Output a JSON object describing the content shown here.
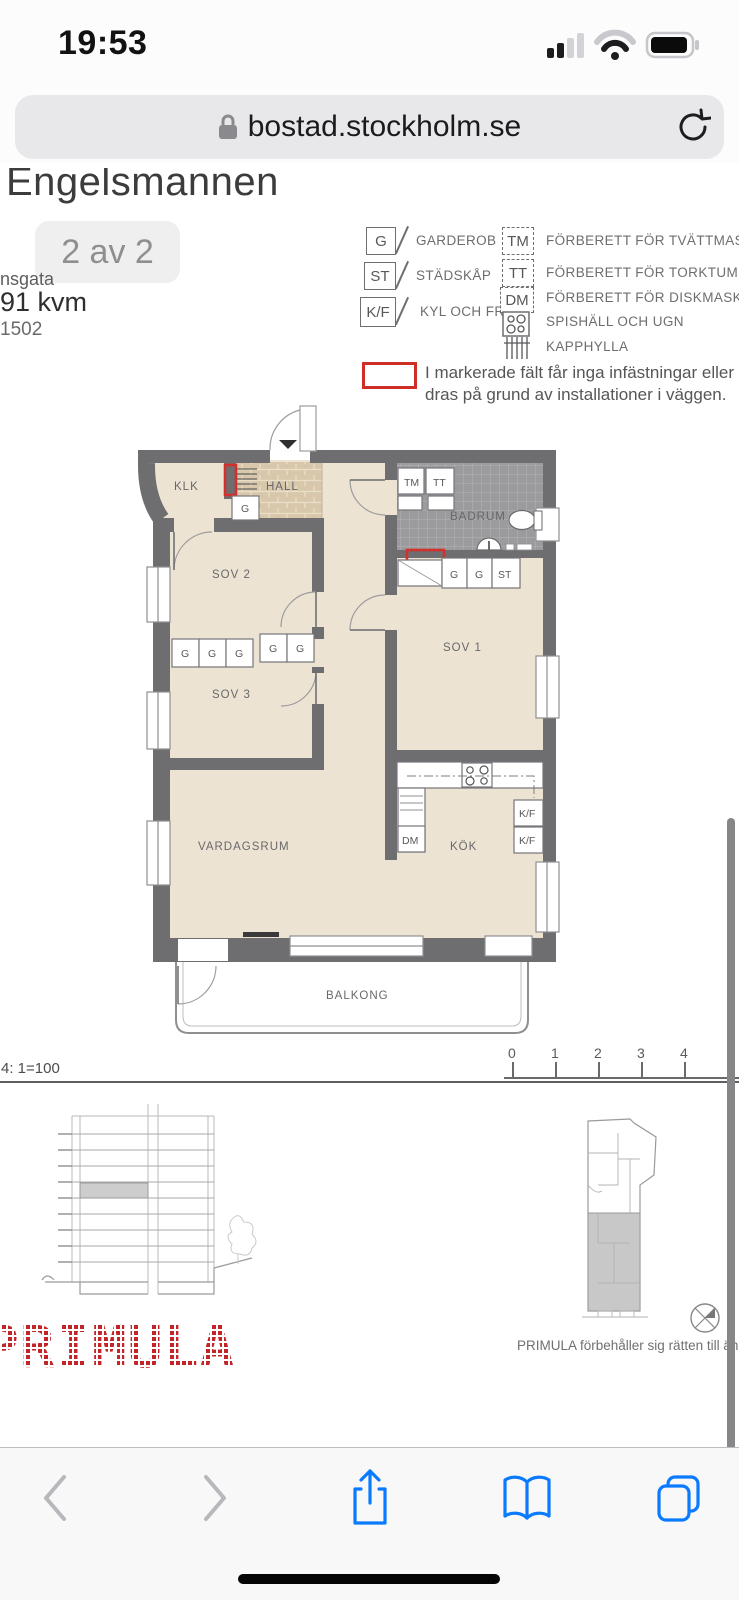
{
  "status_bar": {
    "time": "19:53"
  },
  "browser": {
    "url": "bostad.stockholm.se"
  },
  "listing": {
    "title": "Engelsmannen",
    "pager": "2 av 2",
    "street_fragment": "nsgata",
    "area": "91 kvm",
    "unit_number": "1502"
  },
  "legend": {
    "left": [
      {
        "symbol": "G",
        "label": "GARDEROB"
      },
      {
        "symbol": "ST",
        "label": "STÄDSKÅP"
      },
      {
        "symbol": "K/F",
        "label": "KYL OCH FRYS"
      }
    ],
    "right": [
      {
        "symbol": "TM",
        "label": "FÖRBERETT FÖR TVÄTTMASKIN"
      },
      {
        "symbol": "TT",
        "label": "FÖRBERETT FÖR TORKTUMLARE"
      },
      {
        "symbol": "DM",
        "label": "FÖRBERETT FÖR DISKMASKIN"
      },
      {
        "symbol": "",
        "label": "SPISHÄLL OCH UGN",
        "icon": "stove-icon"
      },
      {
        "symbol": "",
        "label": "KAPPHYLLA",
        "icon": "coat-rack-icon"
      }
    ]
  },
  "note": {
    "line1": "I markerade fält får inga infästningar eller skru",
    "line2": "dras på grund av installationer i väggen."
  },
  "plan": {
    "rooms": {
      "klk": "KLK",
      "hall": "HALL",
      "badrum": "BADRUM",
      "sov1": "SOV 1",
      "sov2": "SOV 2",
      "sov3": "SOV 3",
      "vardagsrum": "VARDAGSRUM",
      "kok": "KÖK",
      "balkong": "BALKONG"
    },
    "labels": {
      "g": "G",
      "st": "ST",
      "tm": "TM",
      "tt": "TT",
      "dm": "DM",
      "kf": "K/F"
    }
  },
  "scale": {
    "label": "4: 1=100",
    "ticks": [
      "0",
      "1",
      "2",
      "3",
      "4"
    ]
  },
  "footer": {
    "logo": "PRIMULA",
    "disclaimer": "PRIMULA förbehåller sig rätten till änd"
  },
  "colors": {
    "ios_blue": "#0a7aff",
    "red_marking": "#d2302c",
    "logo_red": "#c32427",
    "wall_gray": "#6e6e70",
    "floor_beige": "#ece3d3"
  }
}
